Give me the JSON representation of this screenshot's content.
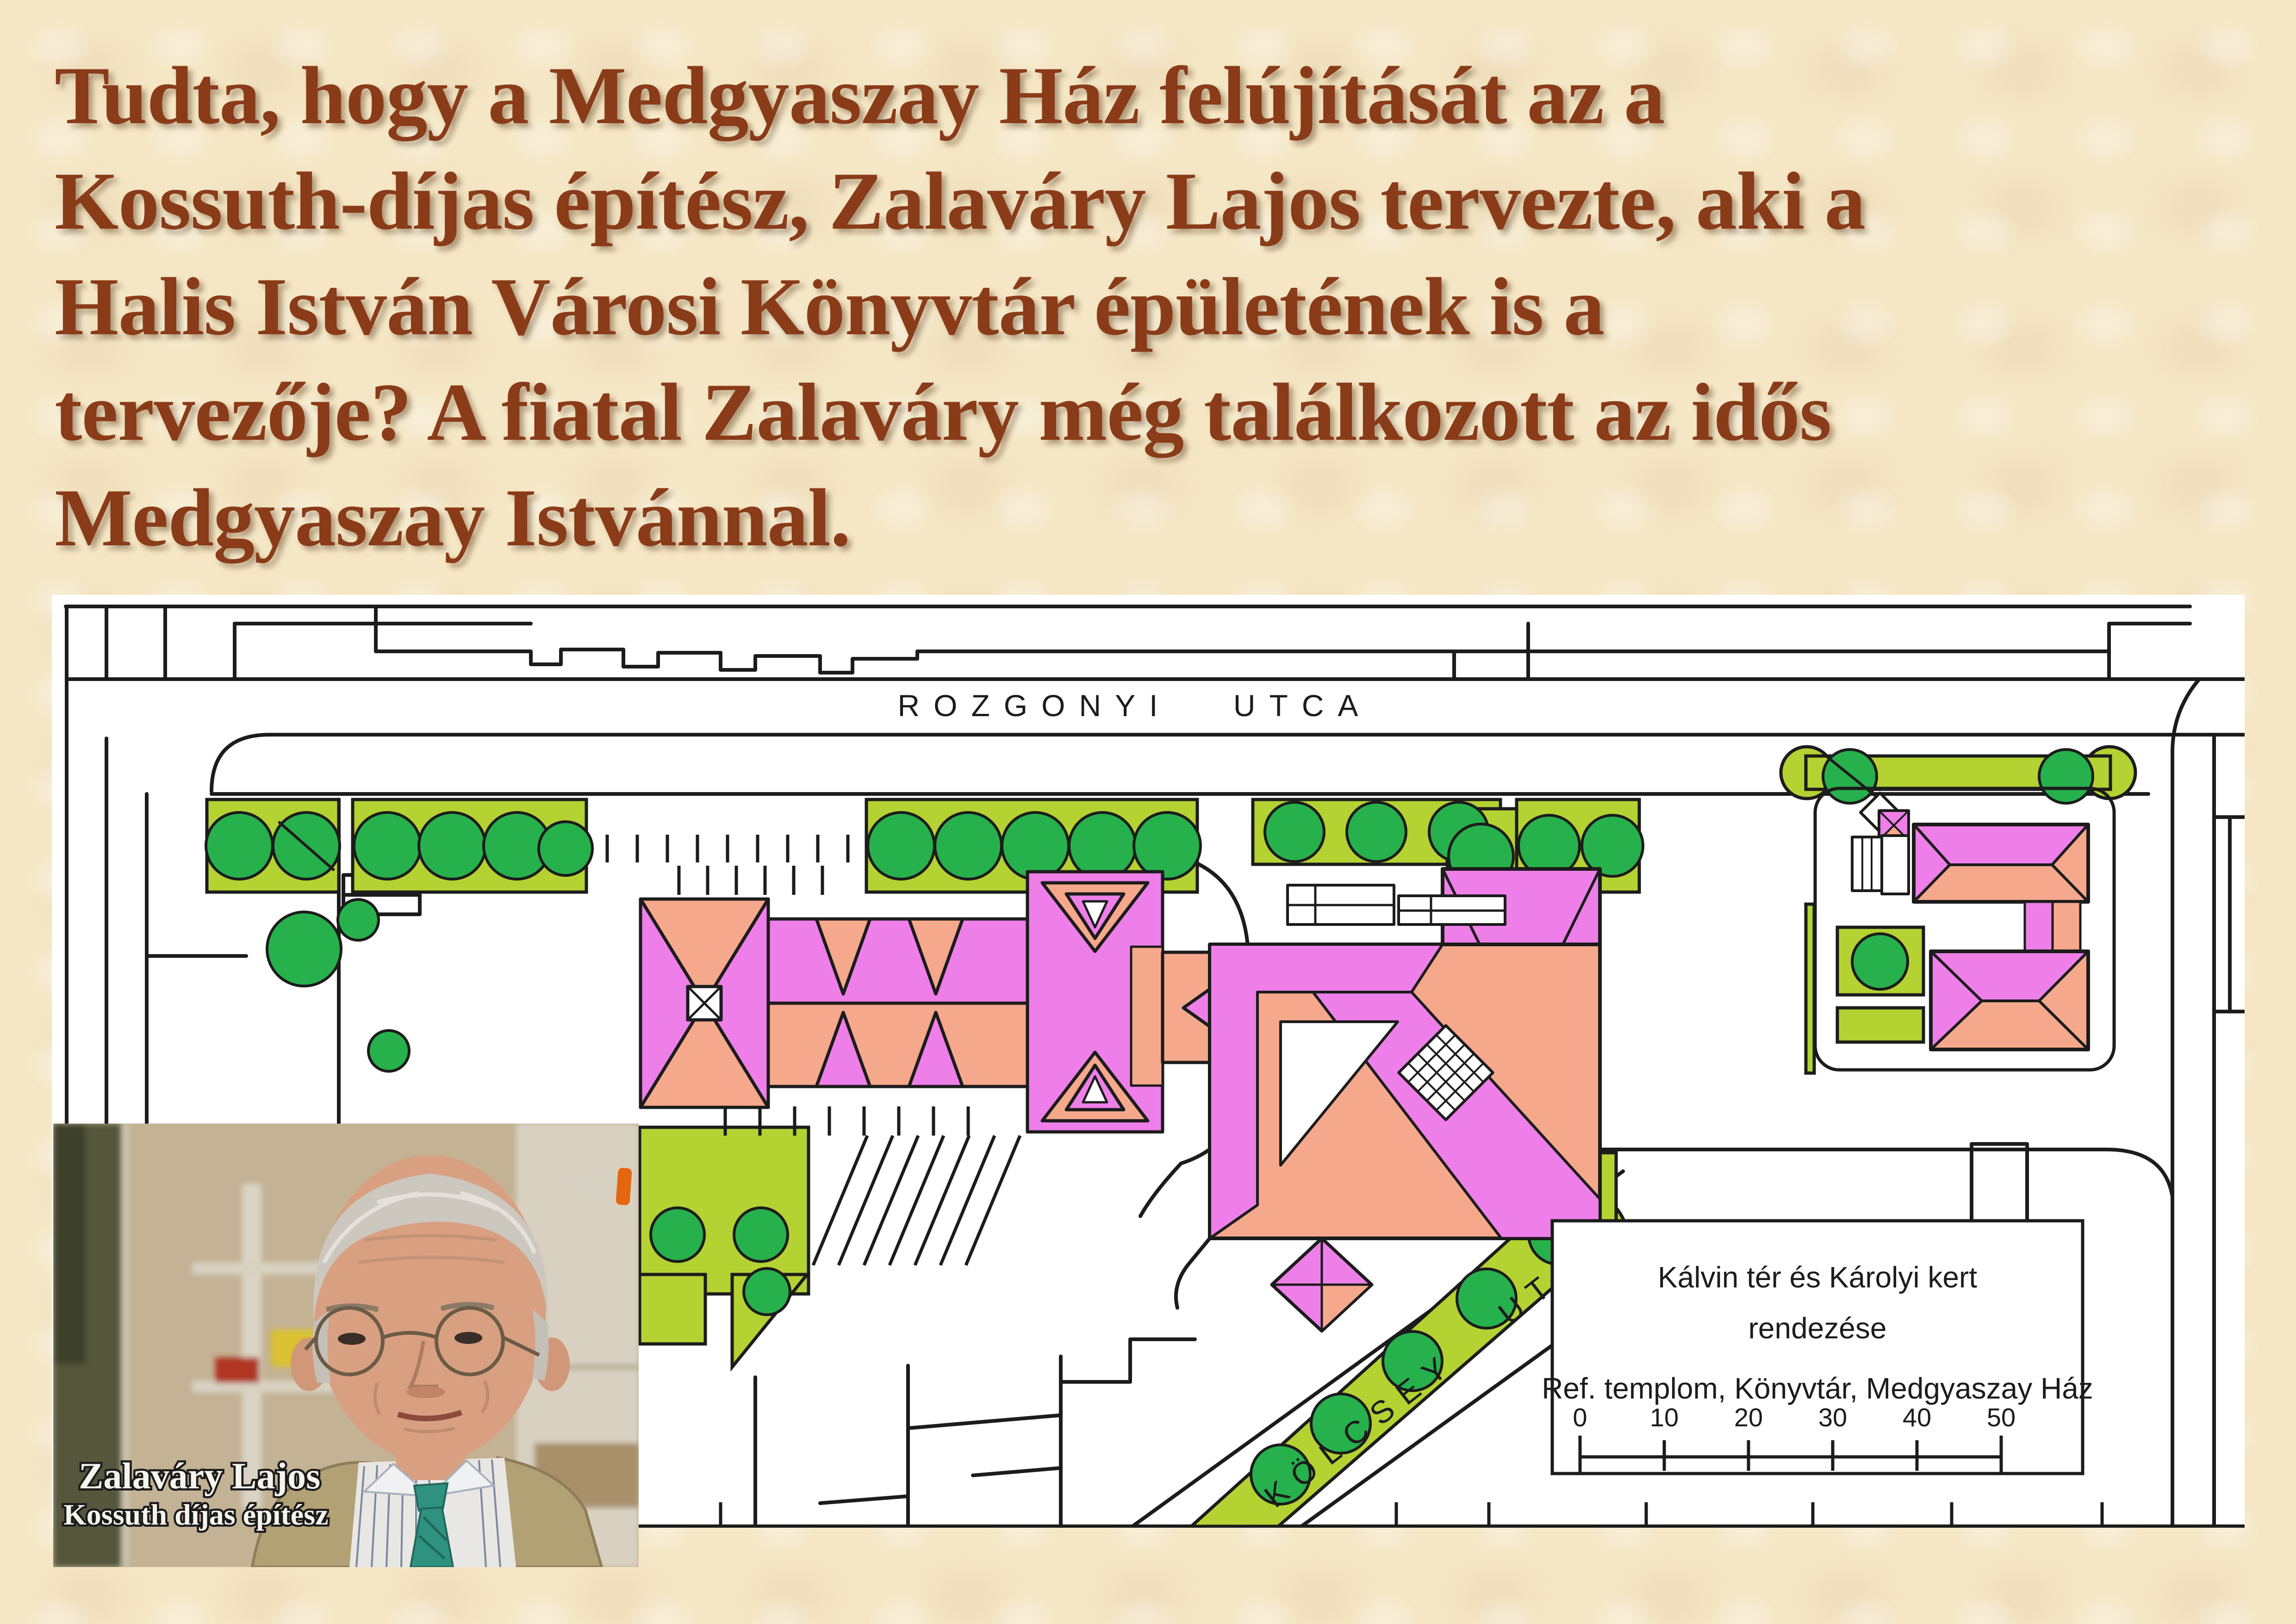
{
  "slide": {
    "background_color": "#f5e7c5"
  },
  "title": {
    "color": "#8a3b18",
    "lines": [
      "Tudta, hogy a Medgyaszay Ház felújítását az a",
      "Kossuth-díjas építész, Zalaváry Lajos tervezte, aki a",
      "Halis István Városi Könyvtár épületének is a",
      "tervezője? A fiatal Zalaváry még találkozott az idős",
      "Medgyaszay Istvánnal."
    ]
  },
  "map": {
    "street_labels": {
      "rozgonyi": "ROZGONYI UTCA",
      "kolcsey": "KÖLCSEY UTCA"
    },
    "legend": {
      "title_lines": [
        "Kálvin tér és Károlyi kert",
        "rendezése",
        "Ref. templom, Könyvtár, Medgyaszay Ház"
      ],
      "scale_ticks": [
        "0",
        "10",
        "20",
        "30",
        "40",
        "50"
      ]
    },
    "colors": {
      "paper": "#ffffff",
      "outline": "#1c1c1c",
      "vegetation": "#b5d233",
      "tree": "#27b14c",
      "roof_pink": "#ee7fe9",
      "roof_salmon": "#f6a88c"
    }
  },
  "photo": {
    "caption_line1": "Zalaváry Lajos",
    "caption_line2": "Kossuth díjas építész",
    "channel_logo": "m2"
  }
}
